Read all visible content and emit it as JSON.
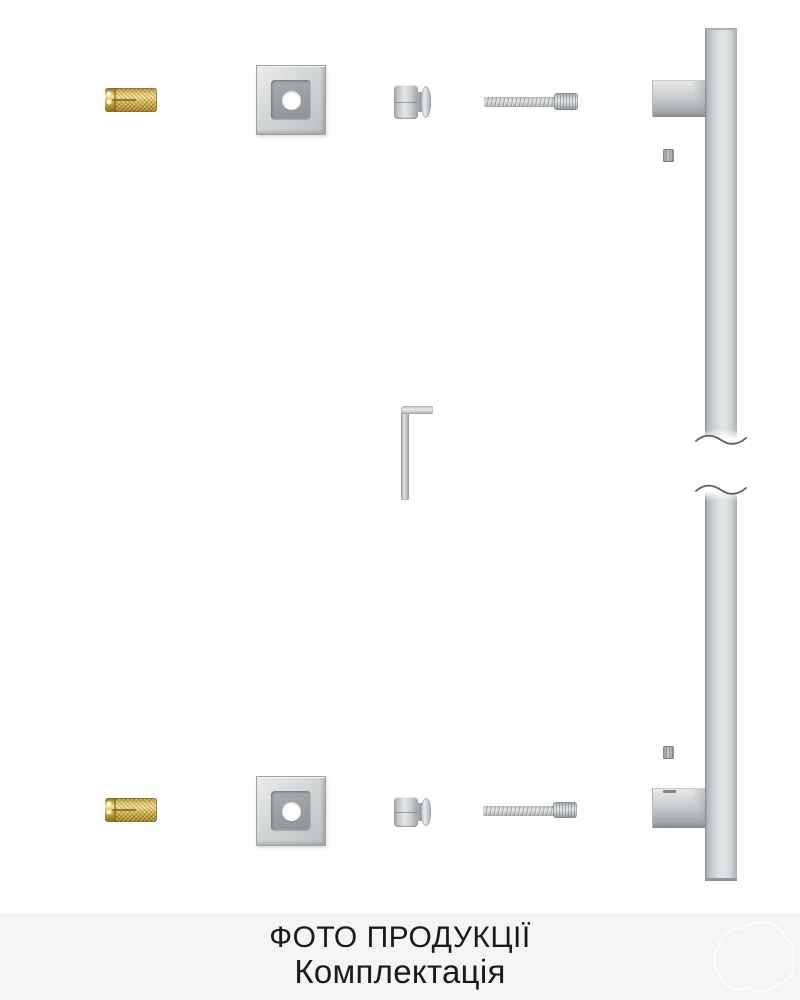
{
  "caption": {
    "line1": "ФОТО ПРОДУКЦІЇ",
    "line2": "Комплектація",
    "background": "#f5f5f5",
    "text_color": "#1a1a1a"
  },
  "colors": {
    "page_background": "#ffffff",
    "brass": "#d9b953",
    "steel_light": "#e4e6e7",
    "steel_mid": "#c2c5c7",
    "steel_dark": "#8f9497",
    "watermark_outline": "#ffffff"
  },
  "kit_items": {
    "wall_anchor": "brass knurled wall anchor",
    "mounting_plate": "square cover plate with round hole",
    "standoff_knob": "handle standoff knob",
    "socket_bolt": "hex socket head bolt",
    "set_screw": "grub set screw",
    "allen_key": "hex allen key",
    "pull_handle": "vertical door pull handle with two mounting arms",
    "break_mark": "photo break squiggle on handle bar"
  }
}
